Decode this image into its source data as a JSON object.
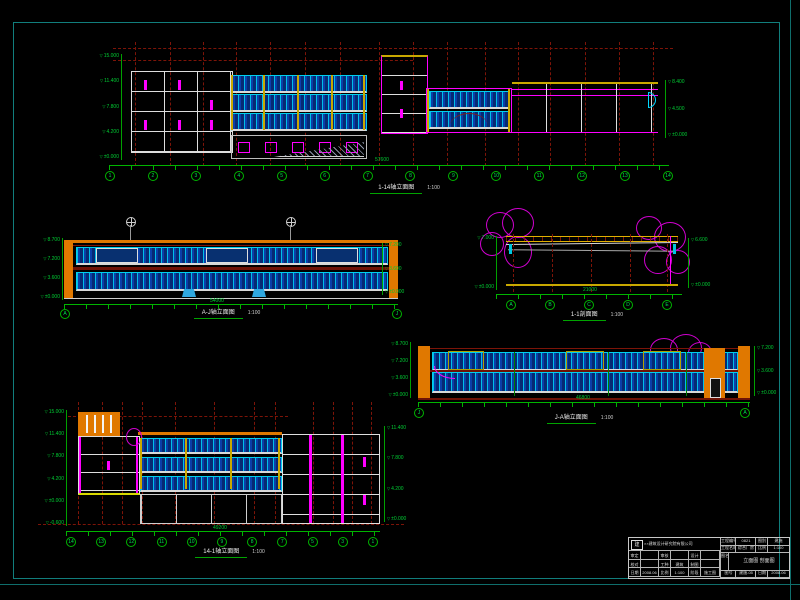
{
  "colors": {
    "background": "#000000",
    "frame_teal": "#117e7c",
    "grid_red": "#7d1408",
    "dim_green": "#00b400",
    "bubble_green": "#00e050",
    "window_cyan": "#00cfee",
    "window_blue": "#0a3fa8",
    "wall_orange": "#e07800",
    "accent_magenta": "#ff00ff",
    "column_yellow": "#c8a800",
    "line_white": "#e8e8e8"
  },
  "drawings": {
    "d1": {
      "title": "1-14轴立面图",
      "scale": "1:100"
    },
    "d2": {
      "title": "A-J轴立面图",
      "scale": "1:100"
    },
    "d3": {
      "title": "1-1剖面图",
      "scale": "1:100"
    },
    "d4": {
      "title": "J-A轴立面图",
      "scale": "1:100"
    },
    "d5": {
      "title": "14-1轴立面图",
      "scale": "1:100"
    }
  },
  "dims": {
    "d1": "57600",
    "d2": "54000",
    "d3": "21000",
    "d4": "46800",
    "d5": "49200"
  },
  "levels": {
    "d1_left": [
      "15.000",
      "11.400",
      "7.800",
      "4.200",
      "±0.000"
    ],
    "d1_right": [
      "8.400",
      "4.500",
      "±0.000"
    ],
    "d2_left": [
      "8.700",
      "7.200",
      "3.600",
      "±0.000"
    ],
    "d2_right": [
      "7.200",
      "3.600",
      "±0.000"
    ],
    "d3_left": [
      "7.000",
      "±0.000"
    ],
    "d3_right": [
      "6.600",
      "±0.000"
    ],
    "d4_left": [
      "8.700",
      "7.200",
      "3.600",
      "±0.000"
    ],
    "d4_right": [
      "7.200",
      "3.600",
      "±0.000"
    ],
    "d5_left": [
      "15.000",
      "11.400",
      "7.800",
      "4.200",
      "±0.000",
      "-0.600"
    ],
    "d5_right": [
      "11.400",
      "7.800",
      "4.200",
      "±0.000"
    ]
  },
  "axes": {
    "d1": [
      "1",
      "2",
      "3",
      "4",
      "5",
      "6",
      "7",
      "8",
      "9",
      "10",
      "11",
      "12",
      "13",
      "14"
    ],
    "d2": [
      "A",
      "J"
    ],
    "d3": [
      "A",
      "B",
      "C",
      "D",
      "E"
    ],
    "d4": [
      "J",
      "A"
    ],
    "d5": [
      "14",
      "13",
      "12",
      "11",
      "10",
      "9",
      "8",
      "7",
      "5",
      "3",
      "1"
    ]
  },
  "title_block": {
    "company": "××建筑设计研究院有限公司",
    "logo": "建",
    "sig_cells": [
      "审定",
      "",
      "审核",
      "",
      "设计",
      "",
      "校对",
      "",
      "工种",
      "建筑",
      "制图",
      "",
      "日期",
      "2008.06",
      "比例",
      "1:100",
      "阶段",
      "施工图"
    ],
    "project_no_label": "工程编号",
    "project_no": "0821",
    "class_label": "图别",
    "class_value": "建施",
    "project_label": "工程名称",
    "project": "综合厂房",
    "scale_label": "比例",
    "scale_value": "1:100",
    "name_label": "图名",
    "drawing_name": "立面图 剖面图",
    "no_label": "图号",
    "no_value": "建施-05",
    "date_label": "日期",
    "date_value": "2008.06"
  }
}
